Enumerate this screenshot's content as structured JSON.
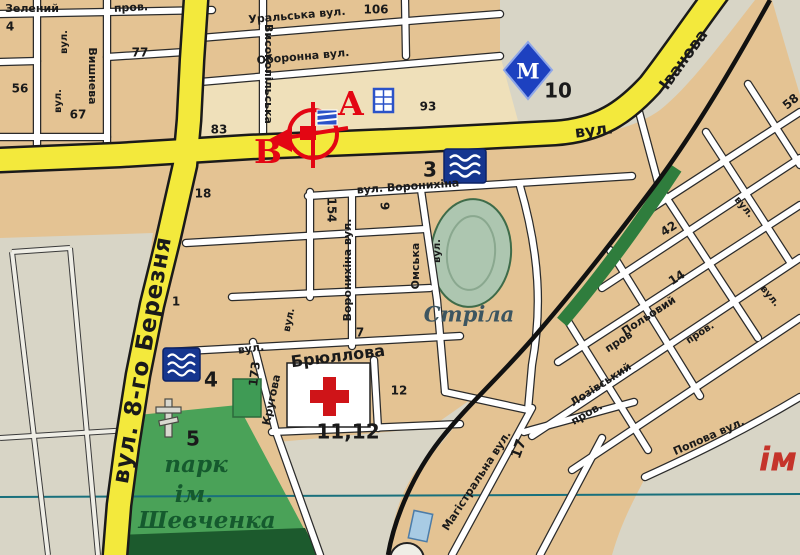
{
  "map": {
    "colors": {
      "main_road": "#f3e93c",
      "minor_road": "#ffffff",
      "block": "#e4c393",
      "block_light": "#efe0ba",
      "open_land": "#d8d5c6",
      "park_green": "#4aa258",
      "park_dark": "#1c5a2d",
      "stadium_green": "#adc6b0",
      "water_icon_blue": "#16368f",
      "railway_black": "#111111",
      "rail_green_strip": "#2f7d3d",
      "poi_red": "#e30613",
      "metro_blue": "#1d41c0",
      "grid_line_teal": "#19707c"
    },
    "labels": [
      {
        "name": "street-label",
        "text": "Зелений",
        "x": 32,
        "y": 9,
        "rot": 0,
        "cls": "st"
      },
      {
        "name": "street-label",
        "text": "пров.",
        "x": 131,
        "y": 8,
        "rot": -3,
        "cls": "st"
      },
      {
        "name": "house-number",
        "text": "4",
        "x": 10,
        "y": 27,
        "rot": 0,
        "cls": "num"
      },
      {
        "name": "street-label",
        "text": "вул.",
        "x": 64,
        "y": 42,
        "rot": -90,
        "cls": "stsm"
      },
      {
        "name": "house-number",
        "text": "56",
        "x": 20,
        "y": 89,
        "rot": 0,
        "cls": "num"
      },
      {
        "name": "street-label",
        "text": "вул.",
        "x": 58,
        "y": 101,
        "rot": -90,
        "cls": "stsm"
      },
      {
        "name": "house-number",
        "text": "67",
        "x": 78,
        "y": 115,
        "rot": 0,
        "cls": "num"
      },
      {
        "name": "street-label",
        "text": "Вишнева",
        "x": 92,
        "y": 76,
        "rot": 90,
        "cls": "st"
      },
      {
        "name": "house-number",
        "text": "77",
        "x": 140,
        "y": 53,
        "rot": 0,
        "cls": "num"
      },
      {
        "name": "street-label",
        "text": "Високопільська",
        "x": 268,
        "y": 74,
        "rot": 90,
        "cls": "st"
      },
      {
        "name": "street-label-uralska",
        "text": "Уральська вул.",
        "x": 297,
        "y": 16,
        "rot": -5,
        "cls": "st"
      },
      {
        "name": "house-number",
        "text": "106",
        "x": 376,
        "y": 10,
        "rot": 0,
        "cls": "num"
      },
      {
        "name": "street-label-oboronna",
        "text": "Оборонна вул.",
        "x": 303,
        "y": 57,
        "rot": -5,
        "cls": "st"
      },
      {
        "name": "house-number",
        "text": "93",
        "x": 428,
        "y": 107,
        "rot": 0,
        "cls": "num"
      },
      {
        "name": "house-number",
        "text": "83",
        "x": 219,
        "y": 130,
        "rot": 0,
        "cls": "num"
      },
      {
        "name": "house-number",
        "text": "18",
        "x": 203,
        "y": 194,
        "rot": 0,
        "cls": "num"
      },
      {
        "name": "street-label-ivanova",
        "text": "вул.",
        "x": 594,
        "y": 131,
        "rot": -7,
        "cls": "stlg"
      },
      {
        "name": "street-label-ivanova",
        "text": "Іванова",
        "x": 684,
        "y": 60,
        "rot": -54,
        "cls": "stlg"
      },
      {
        "name": "street-label-berezni",
        "text": "вул. 8-го Березня",
        "x": 143,
        "y": 360,
        "rot": -80,
        "cls": "stxl"
      },
      {
        "name": "poi-number",
        "text": "10",
        "x": 558,
        "y": 92,
        "rot": 0,
        "cls": "poi"
      },
      {
        "name": "route-point-a",
        "text": "А",
        "x": 351,
        "y": 106,
        "rot": 0,
        "cls": "letter"
      },
      {
        "name": "route-point-b",
        "text": "В",
        "x": 268,
        "y": 154,
        "rot": 0,
        "cls": "letter"
      },
      {
        "name": "poi-number",
        "text": "3",
        "x": 430,
        "y": 171,
        "rot": 0,
        "cls": "poi"
      },
      {
        "name": "street-label-voronykhina",
        "text": "вул. Воронихіна",
        "x": 408,
        "y": 187,
        "rot": -4,
        "cls": "st"
      },
      {
        "name": "house-number",
        "text": "154",
        "x": 331,
        "y": 210,
        "rot": 90,
        "cls": "num"
      },
      {
        "name": "house-number",
        "text": "9",
        "x": 384,
        "y": 206,
        "rot": 90,
        "cls": "num"
      },
      {
        "name": "street-label",
        "text": "Воронихіна вул.",
        "x": 348,
        "y": 270,
        "rot": -90,
        "cls": "st"
      },
      {
        "name": "street-label-omska",
        "text": "Омська",
        "x": 416,
        "y": 266,
        "rot": -90,
        "cls": "st"
      },
      {
        "name": "street-label",
        "text": "вул.",
        "x": 437,
        "y": 251,
        "rot": -90,
        "cls": "stsm"
      },
      {
        "name": "house-number",
        "text": "1",
        "x": 176,
        "y": 302,
        "rot": 0,
        "cls": "num"
      },
      {
        "name": "house-number",
        "text": "7",
        "x": 360,
        "y": 333,
        "rot": 0,
        "cls": "num"
      },
      {
        "name": "street-label",
        "text": "вул.",
        "x": 251,
        "y": 349,
        "rot": -8,
        "cls": "st"
      },
      {
        "name": "street-label-briullova",
        "text": "Брюллова",
        "x": 338,
        "y": 357,
        "rot": -7,
        "cls": "stlg"
      },
      {
        "name": "house-number",
        "text": "173",
        "x": 255,
        "y": 374,
        "rot": -83,
        "cls": "num"
      },
      {
        "name": "house-number",
        "text": "12",
        "x": 399,
        "y": 391,
        "rot": 0,
        "cls": "num"
      },
      {
        "name": "poi-number",
        "text": "11,12",
        "x": 348,
        "y": 433,
        "rot": 0,
        "cls": "poi"
      },
      {
        "name": "street-label",
        "text": "вул.",
        "x": 289,
        "y": 320,
        "rot": -78,
        "cls": "stsm"
      },
      {
        "name": "street-label-kruhova",
        "text": "Кругова",
        "x": 272,
        "y": 400,
        "rot": -78,
        "cls": "st"
      },
      {
        "name": "poi-number",
        "text": "4",
        "x": 211,
        "y": 381,
        "rot": 0,
        "cls": "poi"
      },
      {
        "name": "poi-number",
        "text": "5",
        "x": 193,
        "y": 440,
        "rot": 0,
        "cls": "poi"
      },
      {
        "name": "park-label",
        "text": "парк",
        "x": 196,
        "y": 466,
        "rot": 0,
        "cls": "park"
      },
      {
        "name": "park-label",
        "text": "ім.",
        "x": 194,
        "y": 496,
        "rot": 0,
        "cls": "park"
      },
      {
        "name": "park-label",
        "text": "Шевченка",
        "x": 207,
        "y": 522,
        "rot": 0,
        "cls": "park"
      },
      {
        "name": "stadium-label",
        "text": "Стріла",
        "x": 469,
        "y": 316,
        "rot": 0,
        "cls": "stadium"
      },
      {
        "name": "house-number",
        "text": "17",
        "x": 519,
        "y": 449,
        "rot": -70,
        "cls": "numlg"
      },
      {
        "name": "street-label-mahistralna",
        "text": "Магістральна вул.",
        "x": 477,
        "y": 481,
        "rot": -57,
        "cls": "st"
      },
      {
        "name": "street-label",
        "text": "пров.",
        "x": 587,
        "y": 414,
        "rot": -30,
        "cls": "st"
      },
      {
        "name": "street-label-polovyi",
        "text": "Польовий",
        "x": 649,
        "y": 316,
        "rot": -33,
        "cls": "st"
      },
      {
        "name": "street-label",
        "text": "пров",
        "x": 619,
        "y": 342,
        "rot": -33,
        "cls": "st"
      },
      {
        "name": "street-label-lozivskyi",
        "text": "Лозівський",
        "x": 601,
        "y": 385,
        "rot": -33,
        "cls": "st"
      },
      {
        "name": "street-label-popova",
        "text": "Попова вул.",
        "x": 709,
        "y": 437,
        "rot": -24,
        "cls": "st"
      },
      {
        "name": "factory-label",
        "text": "ім",
        "x": 778,
        "y": 461,
        "rot": 0,
        "cls": "im"
      },
      {
        "name": "house-number",
        "text": "42",
        "x": 669,
        "y": 229,
        "rot": -33,
        "cls": "num"
      },
      {
        "name": "house-number",
        "text": "14",
        "x": 677,
        "y": 278,
        "rot": -33,
        "cls": "num"
      },
      {
        "name": "house-number",
        "text": "58",
        "x": 791,
        "y": 102,
        "rot": -40,
        "cls": "num"
      },
      {
        "name": "street-label",
        "text": "вул.",
        "x": 744,
        "y": 207,
        "rot": 50,
        "cls": "stsm"
      },
      {
        "name": "street-label",
        "text": "вул.",
        "x": 770,
        "y": 296,
        "rot": 50,
        "cls": "stsm"
      },
      {
        "name": "street-label",
        "text": "пров.",
        "x": 700,
        "y": 333,
        "rot": -33,
        "cls": "stsm"
      },
      {
        "name": "metro-m-glyph",
        "text": "М",
        "x": 528,
        "y": 73,
        "rot": 0,
        "cls": "metrom"
      }
    ]
  }
}
